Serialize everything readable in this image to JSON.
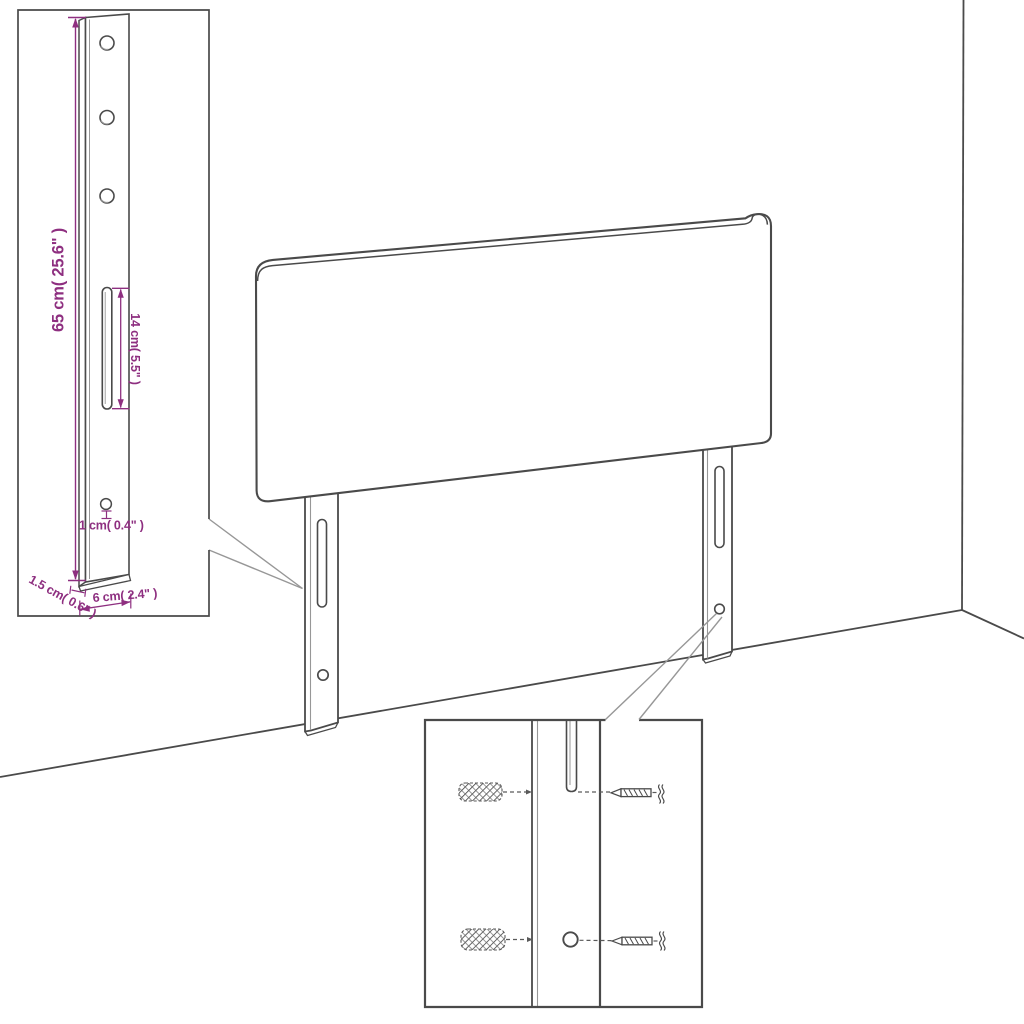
{
  "diagram": {
    "type": "furniture assembly dimension diagram",
    "subject": "upholstered headboard with two wall-mounting legs, shown in a room corner",
    "colors": {
      "background": "#ffffff",
      "line": "#4a4a4a",
      "line_light": "#979797",
      "dimension_text": "#8e2f80"
    },
    "callout_bracket": {
      "description": "enlarged view of mounting leg",
      "height_label": "65 cm( 25.6\" )",
      "slot_label": "14 cm( 5.5\" )",
      "hole_label": "1 cm( 0.4\" )",
      "thickness_label": "1.5 cm( 0.6\" )",
      "width_label": "6 cm( 2.4\" )",
      "hole_count": 3
    },
    "detail_box": {
      "description": "enlarged view of leg hole with wall anchors and screws",
      "rows": 2,
      "parts": [
        "wall-anchor",
        "leg-slot",
        "leg-hole",
        "screw"
      ]
    }
  }
}
